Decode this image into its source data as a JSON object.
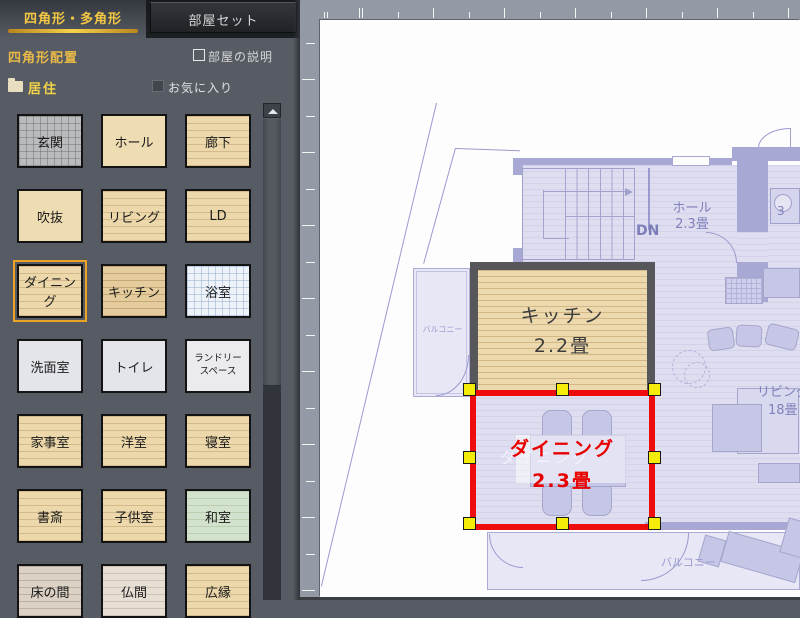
{
  "tabs": {
    "shape_tab": "四角形・多角形",
    "roomset_tab": "部屋セット"
  },
  "panel": {
    "section_title": "四角形配置",
    "room_description_label": "部屋の説明",
    "category_label": "居住",
    "favorites_label": "お気に入り",
    "rooms": [
      {
        "label": "玄関",
        "style": "tile-gray"
      },
      {
        "label": "ホール",
        "style": "plain-tan"
      },
      {
        "label": "廊下",
        "style": "wood-tan"
      },
      {
        "label": "吹抜",
        "style": "plain-tan"
      },
      {
        "label": "リビング",
        "style": "wood-tan"
      },
      {
        "label": "LD",
        "style": "wood-tan"
      },
      {
        "label": "ダイニング",
        "style": "wood-tan",
        "selected": true
      },
      {
        "label": "キッチン",
        "style": "wood-dark"
      },
      {
        "label": "浴室",
        "style": "tile-blue"
      },
      {
        "label": "洗面室",
        "style": "plain-light"
      },
      {
        "label": "トイレ",
        "style": "plain-light"
      },
      {
        "label": "ランドリースペース",
        "style": "plain-white",
        "small": true
      },
      {
        "label": "家事室",
        "style": "wood-tan"
      },
      {
        "label": "洋室",
        "style": "wood-tan"
      },
      {
        "label": "寝室",
        "style": "wood-tan"
      },
      {
        "label": "書斎",
        "style": "wood-tan"
      },
      {
        "label": "子供室",
        "style": "wood-tan"
      },
      {
        "label": "和室",
        "style": "tatami-green"
      },
      {
        "label": "床の間",
        "style": "wood-gray"
      },
      {
        "label": "仏間",
        "style": "wood-light"
      },
      {
        "label": "広縁",
        "style": "wood-tan"
      }
    ]
  },
  "plan": {
    "hall": {
      "name": "ホール",
      "size": "2.3畳"
    },
    "stairs_direction": "DN",
    "kitchen": {
      "name": "キッチン",
      "size": "2.2畳"
    },
    "dining": {
      "name": "ダイニング",
      "size": "2.3畳"
    },
    "living": {
      "name": "リビング",
      "size": "18畳"
    },
    "balcony_left": "バルコニー",
    "balcony_bottom": "バルコニー",
    "partial_room_size": "3"
  },
  "colors": {
    "accent_yellow": "#f4c844",
    "selection_red": "#ee0c0c",
    "handle_yellow": "#f6ec0a",
    "selected_outline": "#eca427"
  }
}
